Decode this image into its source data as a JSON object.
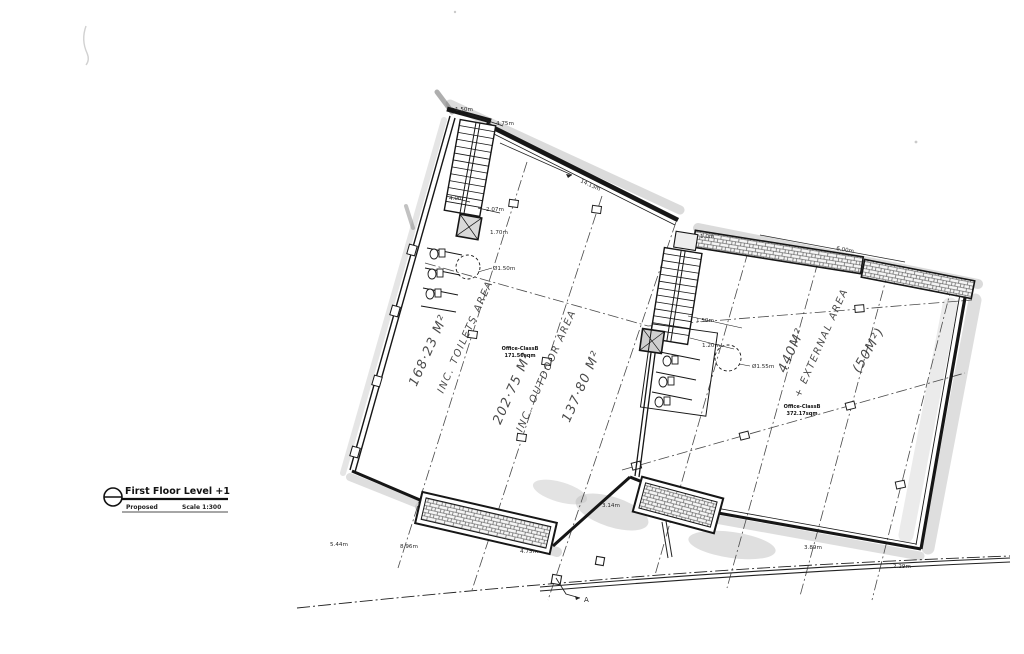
{
  "colors": {
    "paper": "#ffffff",
    "ink": "#1a1a1a",
    "scan_shadow": "#bdbdbd"
  },
  "title_block": {
    "title": "First Floor Level +1",
    "status": "Proposed",
    "scale": "Scale 1:300"
  },
  "plan": {
    "area_labels": {
      "left_area": "168·23 M²",
      "left_note": "INC. TOILETS AREA",
      "mid_area": "202·75 M²",
      "mid_note": "INC. OUTDOOR AREA",
      "mid_area2": "137·80 M²",
      "right_area": "440M²",
      "right_note": "+ EXTERNAL AREA",
      "right_paren": "(50M²)"
    },
    "printed_labels": {
      "left_line1": "Office-ClassB",
      "left_line2": "171.50sqm",
      "right_line1": "Office-ClassB",
      "right_line2": "372.17sqm"
    },
    "dims": {
      "d_150a": "1.50m",
      "d_475a": "4.75m",
      "d_1413": "14.13m",
      "d_40": "4.0m",
      "d_207": "2.07m",
      "d_170": "1.70m",
      "c_150": "Ø1.50m",
      "d_10": "1.0m",
      "d_150b": "1.50m",
      "d_120": "1.20m",
      "c_155": "Ø1.55m",
      "d_600": "6.00m",
      "d_544": "5.44m",
      "d_896": "8.96m",
      "d_475b": "4.75m",
      "d_314": "3.14m",
      "d_389": "3.89m",
      "d_229": "2.29m"
    },
    "section_marker": "A"
  }
}
